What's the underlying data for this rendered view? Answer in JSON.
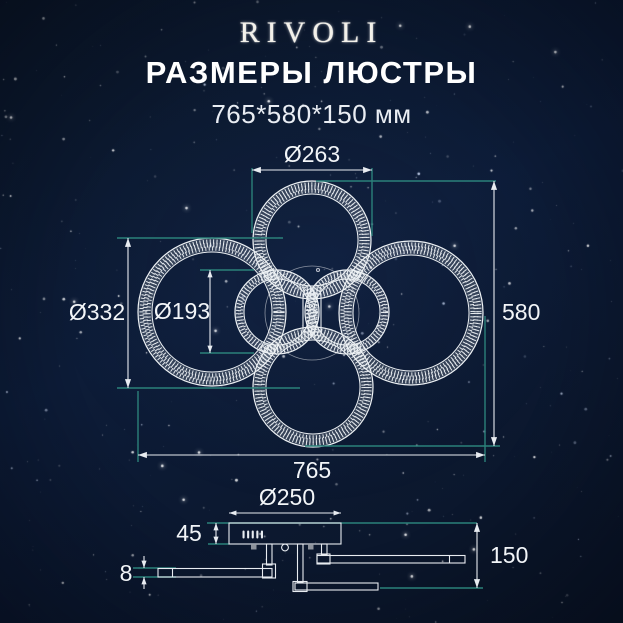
{
  "header": {
    "brand": "RIVOLI",
    "title": "РАЗМЕРЫ ЛЮСТРЫ",
    "subtitle": "765*580*150 мм"
  },
  "front_view": {
    "dim_top_ring_diameter": "Ø263",
    "dim_left_ring_diameter": "Ø332",
    "dim_inner_ring_diameter": "Ø193",
    "dim_overall_height": "580",
    "dim_overall_width": "765"
  },
  "side_view": {
    "dim_canopy_diameter": "Ø250",
    "dim_canopy_height": "45",
    "dim_total_height": "150",
    "dim_ring_thickness": "8"
  },
  "colors": {
    "background": "#0C1A33",
    "extension_line": "#2B817A",
    "dimension_line": "#E8ECF1",
    "text": "#FFFFFF"
  }
}
